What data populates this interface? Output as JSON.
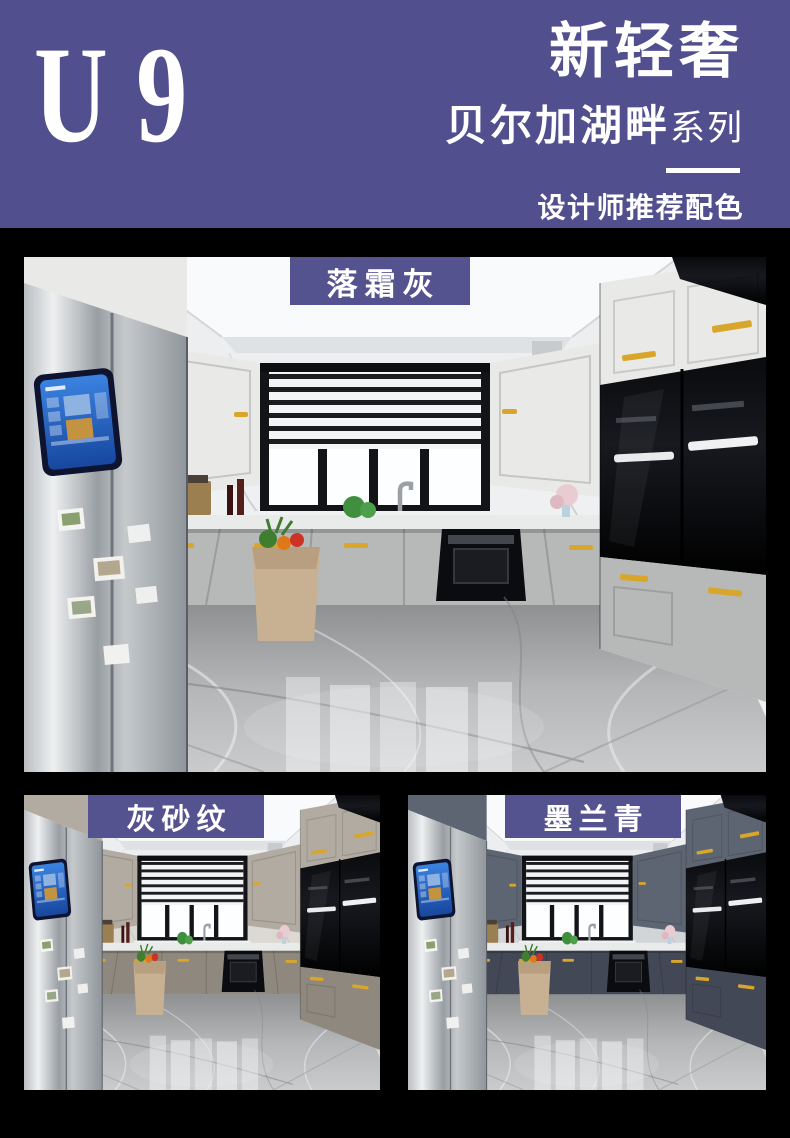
{
  "header": {
    "logo": "U 9",
    "title": "新轻奢",
    "series": "贝尔加湖畔",
    "series_suffix": "系列",
    "tagline": "设计师推荐配色"
  },
  "colors": {
    "brand_purple": "#514f8d",
    "label_purple": "#55538f",
    "background": "#000000",
    "gold_accent": "#d8a62a"
  },
  "swatches": [
    {
      "id": "frost-gray",
      "label": "落霜灰",
      "cab_upper": "#e9eae7",
      "cab_lower": "#b6b9b7",
      "wall": "#eef0f1"
    },
    {
      "id": "gray-sand",
      "label": "灰砂纹",
      "cab_upper": "#b2aba1",
      "cab_lower": "#8f887e",
      "wall": "#dcd8d2"
    },
    {
      "id": "ink-blue",
      "label": "墨兰青",
      "cab_upper": "#5d6572",
      "cab_lower": "#424855",
      "wall": "#d2d5d7"
    }
  ]
}
